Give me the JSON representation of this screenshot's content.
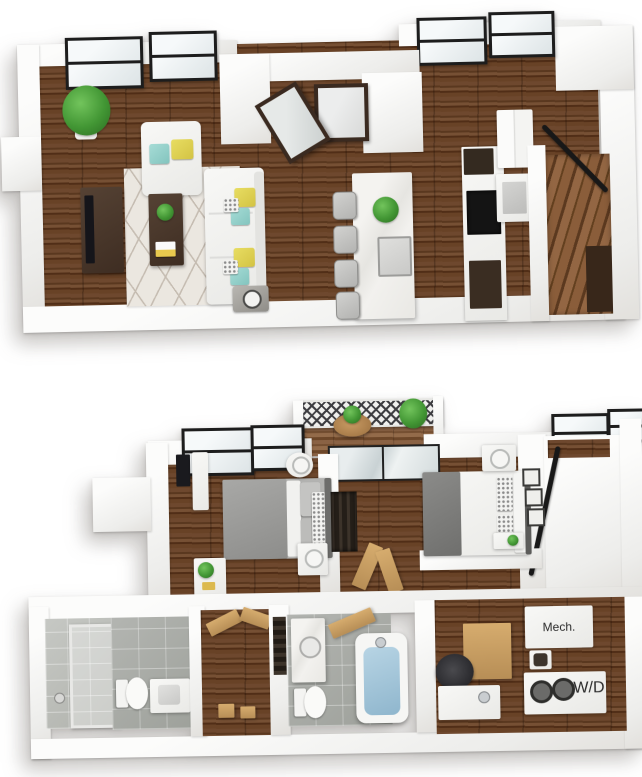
{
  "canvas": {
    "width": 642,
    "height": 777,
    "background": "#ffffff",
    "description": "two 3D isometric apartment floor plan renderings stacked vertically"
  },
  "labels": {
    "mech": "Mech.",
    "wd": "W/D"
  },
  "colors": {
    "wall_white": "#f5f4f2",
    "wood_floor": "#5e3d26",
    "stair_wood": "#7c5434",
    "light_wood_floor": "#82593a",
    "rug": "#ebe7e0",
    "rug_line": "#c5bcb1",
    "window_frame": "#1d1d1d",
    "glass": "#dde4e6",
    "door_wood_dark": "#3a2a20",
    "door_wood_tan": "#c99e63",
    "sofa_white": "#f3f3f1",
    "pillow_yellow": "#ddcf55",
    "pillow_teal": "#94cfc9",
    "plant_green": "#46a035",
    "island_marble": "#f0efec",
    "stool_gray": "#c3c3c1",
    "cabinet_dark": "#3a2d22",
    "cooktop_black": "#161616",
    "bed_gray": "#9e9e9e",
    "tile_gray": "#a8aaa4",
    "tub_water": "#9fc3da",
    "railing_black": "#181818"
  },
  "upper_plan": {
    "name": "upper-level-open-plan",
    "rooms": [
      {
        "name": "living-room",
        "furniture": [
          "corner-potted-plant",
          "armchair",
          "geometric-area-rug",
          "tv-console",
          "coffee-table",
          "sofa-with-pillows",
          "side-table-lamp"
        ],
        "windows": 2
      },
      {
        "name": "entry",
        "furniture": [
          "double-entry-doors-one-open"
        ]
      },
      {
        "name": "kitchen",
        "furniture": [
          "marble-island-with-sink-and-plant",
          "bar-stools-x4",
          "cooktop",
          "oven-box",
          "refrigerator",
          "dark-cabinets"
        ],
        "windows": 2
      },
      {
        "name": "staircase",
        "furniture": [
          "wood-treads",
          "black-handrail"
        ]
      }
    ]
  },
  "lower_plan": {
    "name": "lower-level-bedrooms",
    "rooms": [
      {
        "name": "balcony",
        "furniture": [
          "lattice-railing",
          "bistro-table",
          "potted-plants"
        ]
      },
      {
        "name": "bedroom-1",
        "furniture": [
          "gray-bed",
          "round-nightstand-lamp",
          "nightstand-lamp",
          "dresser-with-plant",
          "wall-tv",
          "wardrobe",
          "closet-hanging-clothes"
        ],
        "windows": 2
      },
      {
        "name": "bedroom-2",
        "furniture": [
          "bed-patterned-pillows",
          "nightstand-lamp",
          "art-frames-x3",
          "breakfast-tray",
          "sliding-glass-door"
        ],
        "windows": 2
      },
      {
        "name": "bathroom-1",
        "furniture": [
          "glass-shower",
          "toilet",
          "vanity-sink"
        ]
      },
      {
        "name": "hall-closet",
        "furniture": [
          "open-wood-doors",
          "storage-boxes"
        ]
      },
      {
        "name": "bathroom-2",
        "furniture": [
          "vanity-sink",
          "toilet",
          "bathtub-filled"
        ]
      },
      {
        "name": "utility-nook",
        "furniture": [
          "wall-cabinet",
          "office-chair",
          "utility-table"
        ]
      },
      {
        "name": "mechanical-closet",
        "label_ref": "labels.mech"
      },
      {
        "name": "laundry-closet",
        "label_ref": "labels.wd",
        "furniture": [
          "stacked-washer-dryer"
        ]
      },
      {
        "name": "stair-corridor",
        "furniture": [
          "black-handrail"
        ]
      }
    ]
  }
}
